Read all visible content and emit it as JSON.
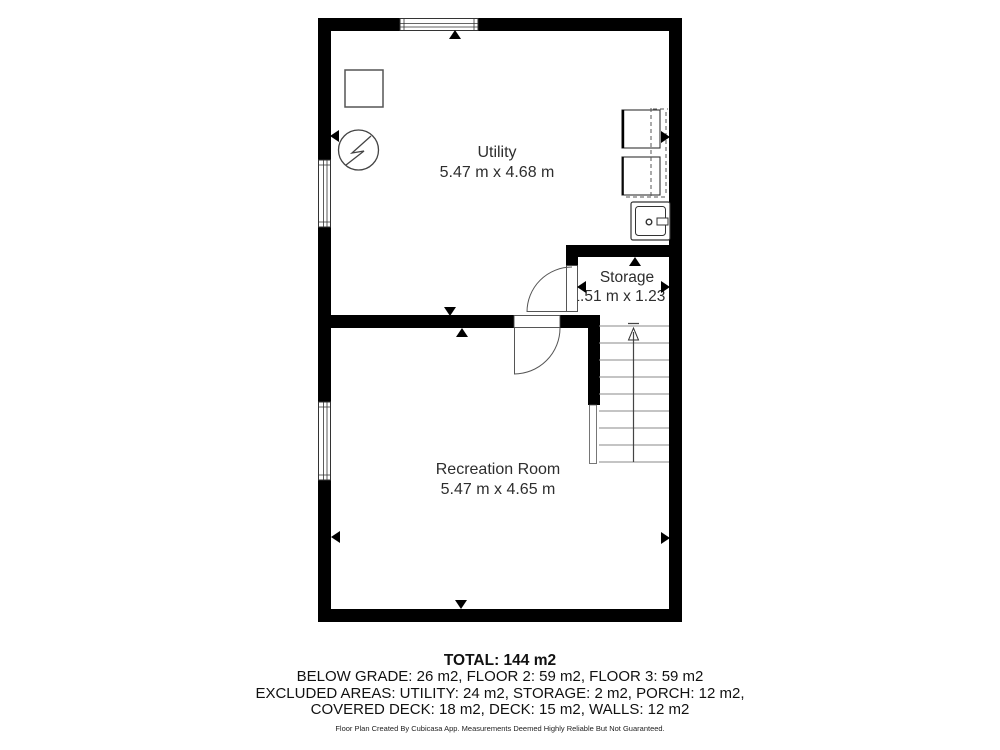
{
  "plan": {
    "rooms": [
      {
        "name": "Utility",
        "dims": "5.47 m x 4.68 m"
      },
      {
        "name": "Storage",
        "dims": "1.51 m x 1.23 m"
      },
      {
        "name": "Recreation Room",
        "dims": "5.47 m x 4.65 m"
      }
    ],
    "icons": [
      "appliance-box-icon",
      "electrical-panel-icon",
      "washer-icon",
      "dryer-icon",
      "laundry-sink-icon",
      "staircase-up-arrow-icon",
      "window-icon",
      "door-swing-icon",
      "wall-midpoint-marker-icon"
    ],
    "colors": {
      "wall": "#000000",
      "background": "#ffffff",
      "text": "#2b2b2b",
      "tread": "#888888"
    }
  },
  "summary": {
    "total": "TOTAL: 144 m2",
    "line1": "BELOW GRADE: 26 m2, FLOOR 2: 59 m2, FLOOR 3: 59 m2",
    "line2": "EXCLUDED AREAS: UTILITY: 24 m2, STORAGE: 2 m2, PORCH: 12 m2,",
    "line3": "COVERED DECK: 18 m2, DECK: 15 m2, WALLS: 12 m2"
  },
  "footer": "Floor Plan Created By Cubicasa App. Measurements Deemed Highly Reliable But Not Guaranteed."
}
